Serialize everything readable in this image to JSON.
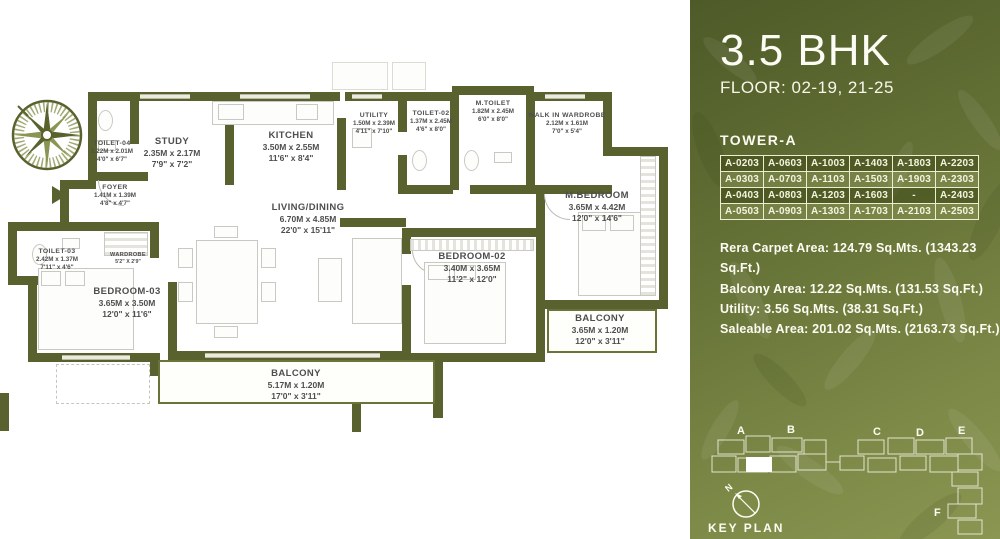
{
  "panel": {
    "title": "3.5 BHK",
    "floor": "FLOOR: 02-19, 21-25",
    "tower": {
      "label": "TOWER-A",
      "units": [
        [
          "A-0203",
          "A-0603",
          "A-1003",
          "A-1403",
          "A-1803",
          "A-2203"
        ],
        [
          "A-0303",
          "A-0703",
          "A-1103",
          "A-1503",
          "A-1903",
          "A-2303"
        ],
        [
          "A-0403",
          "A-0803",
          "A-1203",
          "A-1603",
          "-",
          "A-2403"
        ],
        [
          "A-0503",
          "A-0903",
          "A-1303",
          "A-1703",
          "A-2103",
          "A-2503"
        ]
      ]
    },
    "areas": [
      "Rera Carpet Area: 124.79 Sq.Mts. (1343.23 Sq.Ft.)",
      "Balcony Area: 12.22 Sq.Mts. (131.53 Sq.Ft.)",
      "Utility: 3.56 Sq.Mts. (38.31 Sq.Ft.)",
      "Saleable Area: 201.02 Sq.Mts. (2163.73 Sq.Ft.)"
    ],
    "keyplan": {
      "label": "KEY PLAN",
      "compass": "N",
      "towers": [
        "A",
        "B",
        "C",
        "D",
        "E",
        "F"
      ]
    }
  },
  "floorplan": {
    "rooms": [
      {
        "name": "TOILET-04",
        "m": "1.22M x 2.01M",
        "ft": "4'0\" x 6'7\""
      },
      {
        "name": "STUDY",
        "m": "2.35M x 2.17M",
        "ft": "7'9\" x 7'2\""
      },
      {
        "name": "FOYER",
        "m": "1.41M x 1.39M",
        "ft": "4'8\" x 4'7\""
      },
      {
        "name": "KITCHEN",
        "m": "3.50M x 2.55M",
        "ft": "11'6\" x 8'4\""
      },
      {
        "name": "UTILITY",
        "m": "1.50M x 2.39M",
        "ft": "4'11\" x 7'10\""
      },
      {
        "name": "TOILET-02",
        "m": "1.37M x 2.45M",
        "ft": "4'6\" x 8'0\""
      },
      {
        "name": "M.TOILET",
        "m": "1.82M x 2.45M",
        "ft": "6'0\" x 8'0\""
      },
      {
        "name": "WALK IN WARDROBE",
        "m": "2.12M x 1.61M",
        "ft": "7'0\" x 5'4\""
      },
      {
        "name": "M.BEDROOM",
        "m": "3.65M x 4.42M",
        "ft": "12'0\" x 14'6\""
      },
      {
        "name": "LIVING/DINING",
        "m": "6.70M x 4.85M",
        "ft": "22'0\" x 15'11\""
      },
      {
        "name": "BEDROOM-02",
        "m": "3.40M x 3.65M",
        "ft": "11'2\" x 12'0\""
      },
      {
        "name": "TOILET-03",
        "m": "2.42M x 1.37M",
        "ft": "7'11\" x 4'6\""
      },
      {
        "name": "WARDROBE",
        "ft": "5'2\" X 2'9\""
      },
      {
        "name": "BEDROOM-03",
        "m": "3.65M x 3.50M",
        "ft": "12'0\" x 11'6\""
      },
      {
        "name": "BALCONY",
        "m": "3.65M x 1.20M",
        "ft": "12'0\" x 3'11\""
      },
      {
        "name": "BALCONY",
        "m": "5.17M x 1.20M",
        "ft": "17'0\" x 3'11\""
      }
    ]
  }
}
